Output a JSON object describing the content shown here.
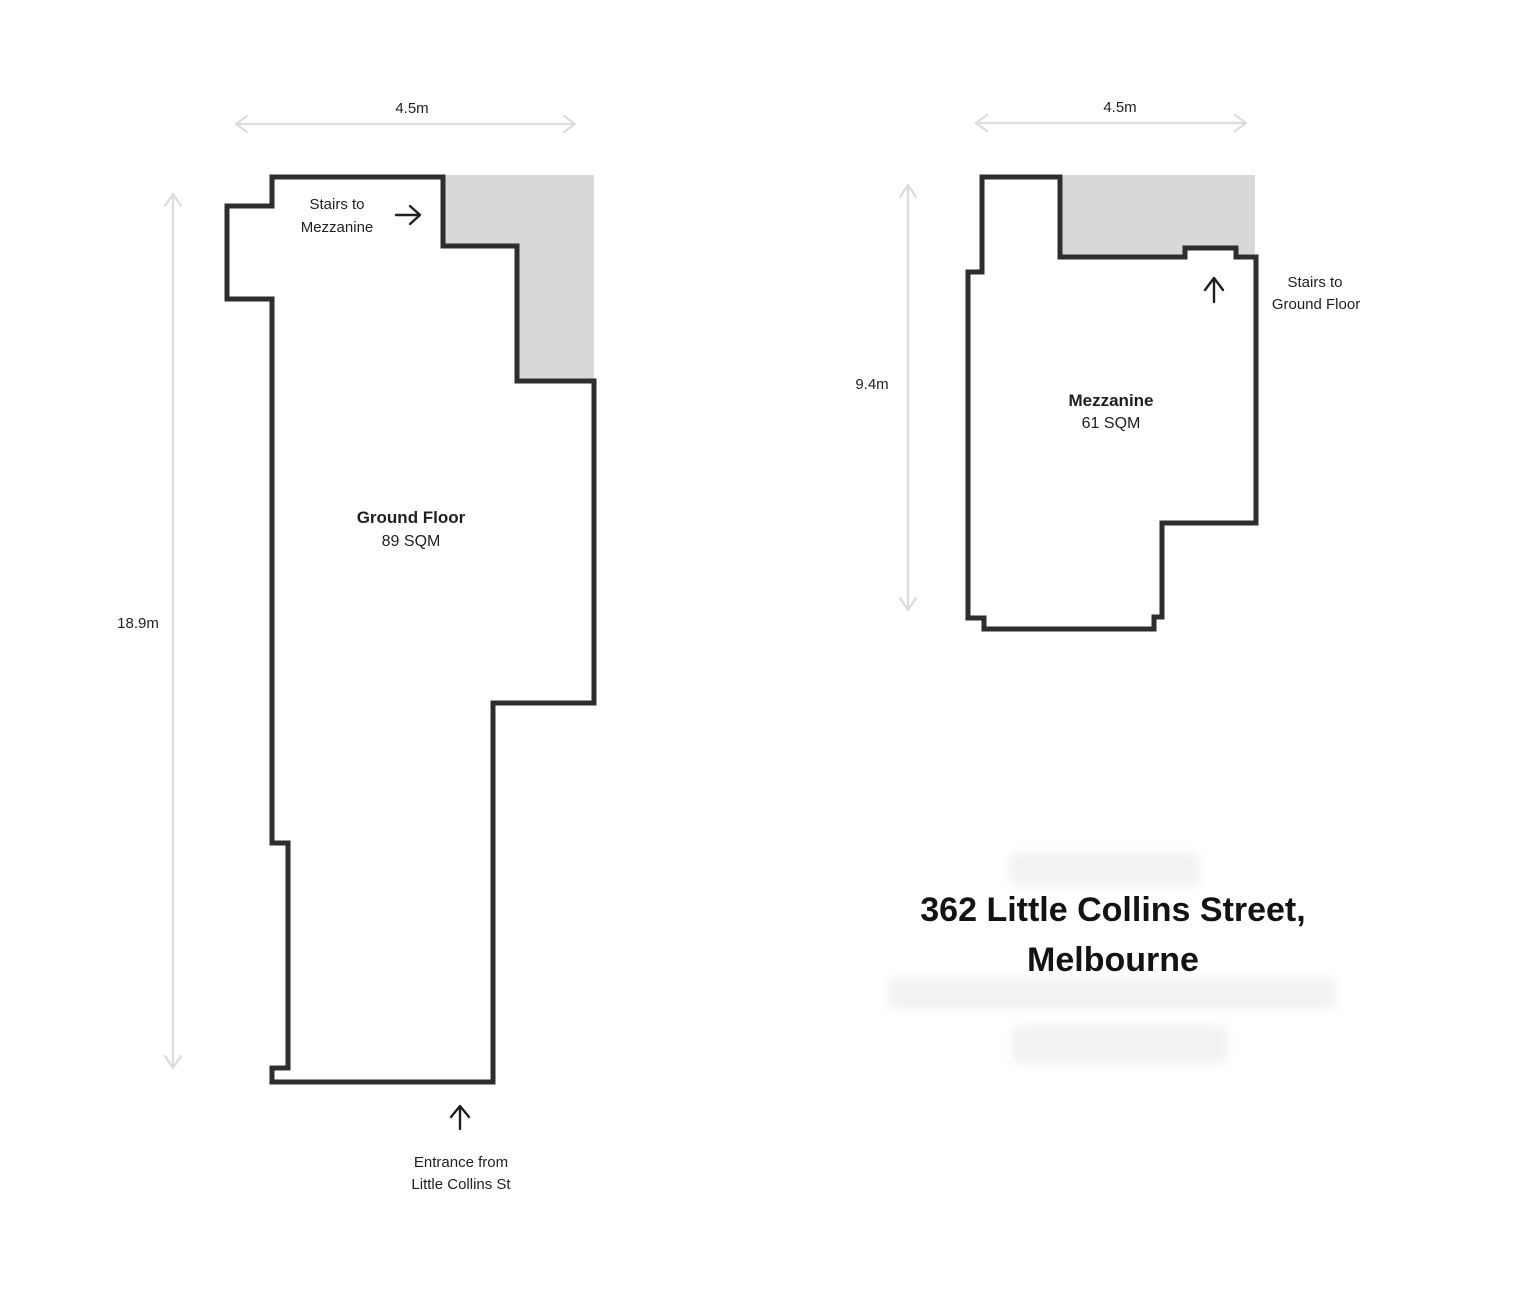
{
  "document_title": {
    "line1": "362 Little Collins Street,",
    "line2": "Melbourne"
  },
  "ground_floor": {
    "name": "Ground Floor",
    "area": "89 SQM",
    "width_dimension": "4.5m",
    "height_dimension": "18.9m",
    "stairs_label": {
      "line1": "Stairs to",
      "line2": "Mezzanine"
    },
    "entrance_label": {
      "line1": "Entrance from",
      "line2": "Little Collins St"
    }
  },
  "mezzanine": {
    "name": "Mezzanine",
    "area": "61 SQM",
    "width_dimension": "4.5m",
    "height_dimension": "9.4m",
    "stairs_label": {
      "line1": "Stairs to",
      "line2": "Ground Floor"
    }
  },
  "icons": {
    "ground_floor_stairs": "arrow-right",
    "ground_floor_entrance": "arrow-up",
    "mezzanine_stairs": "arrow-up",
    "dimensions": "double-headed-arrow"
  },
  "colors": {
    "wall": "#2e2e2e",
    "void_fill": "#d8d8d8",
    "dimension_arrow": "#dcdcdc",
    "text": "#1f1f1f",
    "background": "#ffffff"
  }
}
